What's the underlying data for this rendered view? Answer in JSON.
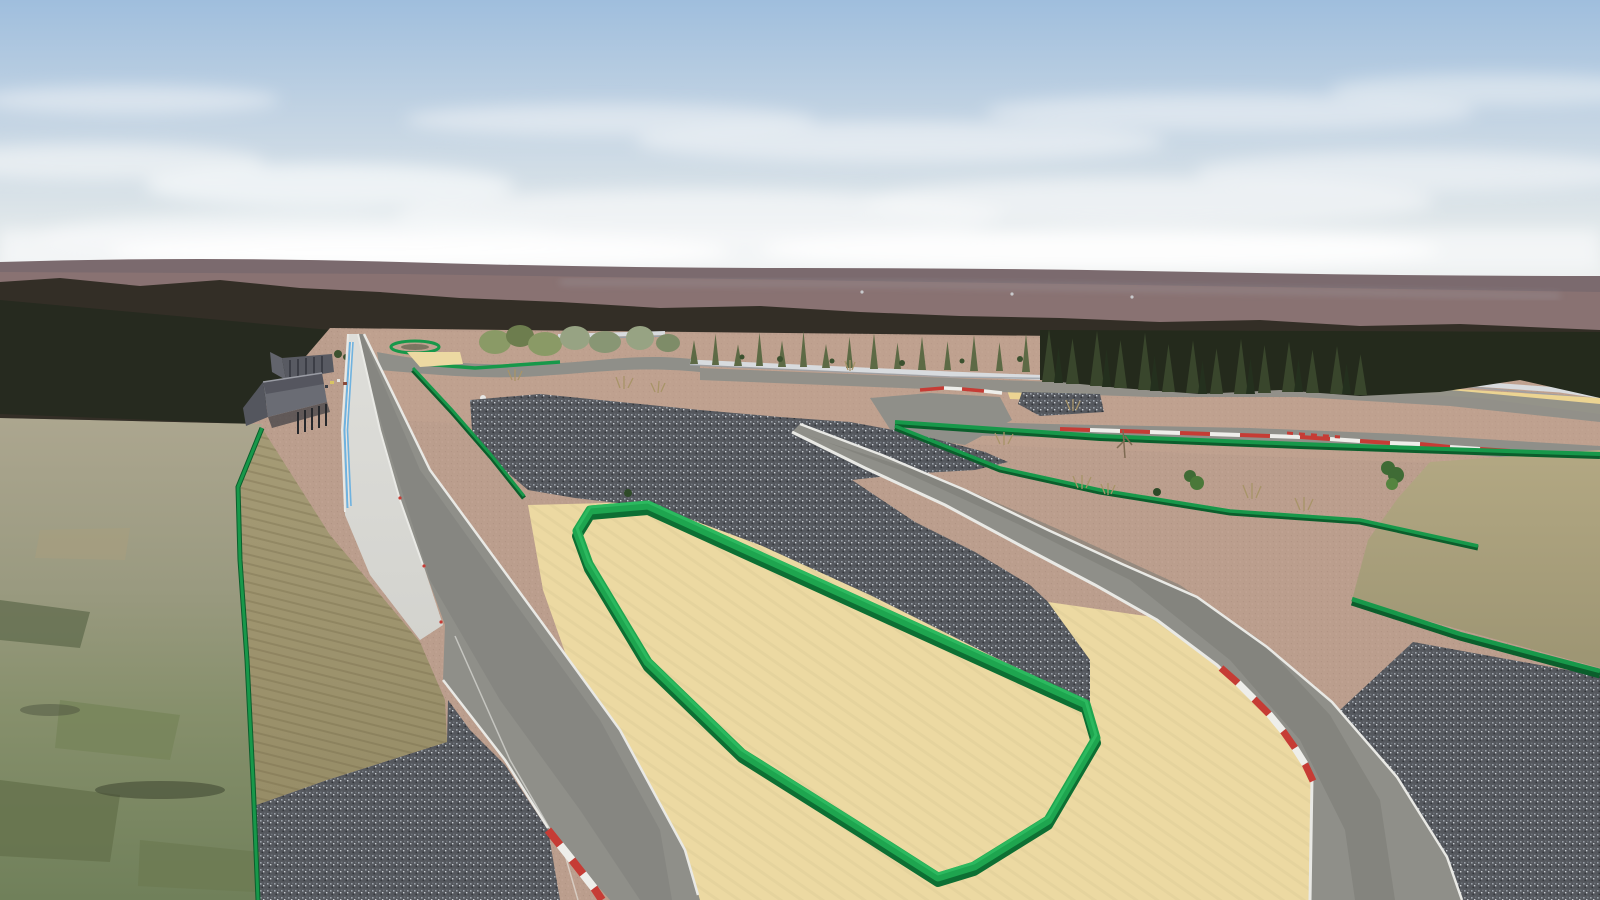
{
  "meta": {
    "width": 900,
    "height": 900,
    "view": "3D trackside preview of a motorsport circuit under construction, camera above pit straight looking along the venue"
  },
  "scene": {
    "sky": {
      "top": "#9fbedd",
      "mid": "#c2d3e3",
      "low": "#dde5e9",
      "horizon": "#edefee",
      "cloud": "#f6f8f9"
    },
    "horizon": {
      "far_hills": "#7b6a6e",
      "hills_texture": "#8d7674",
      "ridge_highlight": "#a9b1bb",
      "forest": "#332e26",
      "forest_dark": "#262a1f"
    },
    "vegetation": {
      "conifer_block": "#242a1c",
      "conifer": "#39462c",
      "conifer_shade": "#24301e",
      "conifer_light": "#5d6a45",
      "tree_light": "#8a9a66",
      "tree_pale": "#97a383",
      "bush_green": "#3f6b35",
      "bush_dark": "#2e4a28",
      "tuft_dry": "#a89468"
    },
    "terrain": {
      "dirt": "#bb9e8d",
      "dirt_distant": "#c8a795",
      "sand": "#ecd9a2",
      "gravel": "#55585e",
      "embankment": "#a59b76",
      "embankment_low": "#968c66",
      "flat_ground": "#aca68f",
      "aerial_green": "#87906c",
      "aerial_green_dark": "#5d684a",
      "aerial_green_light": "#a59d7f",
      "aerial_patch": "#77845a",
      "tan_patch": "#b3a883",
      "tan_patch_low": "#9d9573"
    },
    "track": {
      "asphalt": "#8f8f89",
      "asphalt_worn": "#7d7d77",
      "edge_line": "#e9e9e5",
      "pit_surface": "#d3d3ce",
      "pit_surface_light": "#dedeDA",
      "pit_blue": "#6fb2df",
      "curb_red": "#c63c35",
      "curb_white": "#eeeeea",
      "wall_white": "#d8dbde",
      "wall_shadow": "#9aa0a6",
      "sand_strip_yellow": "#ecd492"
    },
    "barriers": {
      "green_wall": "#1ea54f",
      "green_wall_dark": "#0d6f33",
      "green_wall_highlight": "#2fbc62",
      "fence_green": "#17984a",
      "fence_green_dark": "#0b5e2c"
    },
    "pit_building": {
      "roof_light": "#6a6c74",
      "roof_dark": "#44464e",
      "deck": "#585a62",
      "wing": "#54565e",
      "posts": "#26282c",
      "shadow": "#3a3c42"
    },
    "pit_objects": {
      "marker_yellow": "#d8c463",
      "marker_white": "#e6e6e2",
      "marker_red": "#8a4a3a",
      "marker_dark": "#3a3e46"
    }
  }
}
